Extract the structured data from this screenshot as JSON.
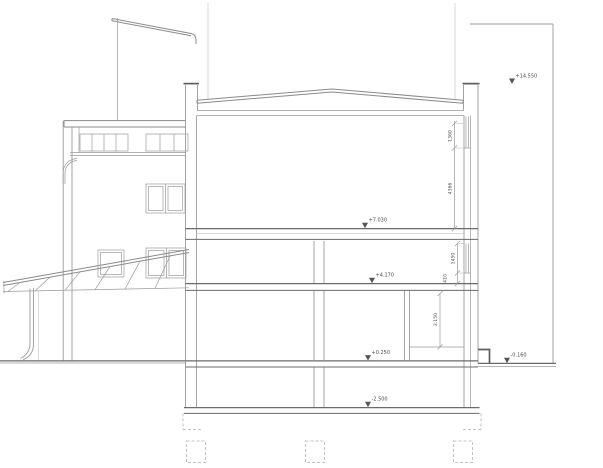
{
  "drawing": {
    "type": "architectural-cross-section",
    "levels": {
      "boundary_height": "+14.550",
      "hall_floor": "+7.030",
      "upper_floor": "+4.170",
      "ground_floor": "+0.250",
      "basement_floor": "-2.500",
      "exterior_grade": "-0.160"
    },
    "dimensions": {
      "clerestory_window_height": "1360",
      "hall_wall_height": "4366",
      "upper_window_height": "1450",
      "sill_height": "410",
      "room_clear_height": "2.150"
    },
    "colors": {
      "background": "#ffffff",
      "line": "#9a9a9a",
      "dark_line": "#6a6a6a",
      "text": "#4a4a4a"
    }
  }
}
